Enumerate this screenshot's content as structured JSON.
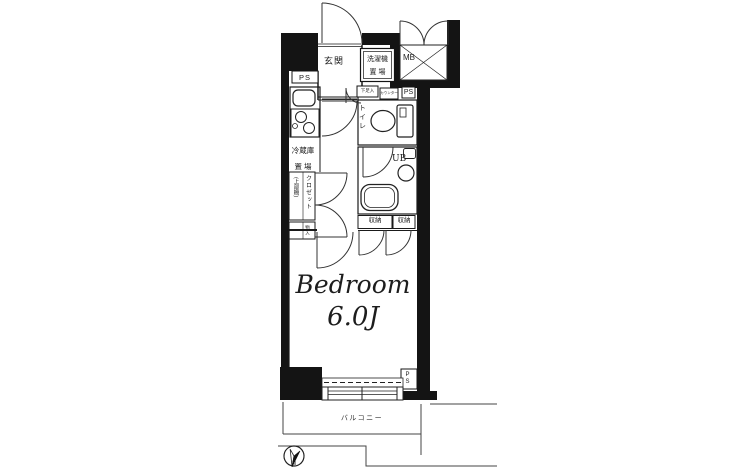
{
  "labels": {
    "genkan": "玄関",
    "ps_top": "PS",
    "washer_line1": "洗濯機",
    "washer_line2": "置 場",
    "mb": "MB",
    "shoe_cupboard": "下足入",
    "counter": "カウンター",
    "ps_mid": "PS",
    "toilet": "トイレ",
    "fridge_line1": "冷蔵庫",
    "fridge_line2": "置 場",
    "closet_name": "クロゼット",
    "closet_note": "(上部棚)",
    "closet_lower": "物入",
    "ub": "UB",
    "storage_left": "収納",
    "storage_right": "収納",
    "bedroom_name": "Bedroom",
    "bedroom_size": "6.0J",
    "ps_bottom": "PS",
    "balcony": "バルコニー",
    "compass_north": "N"
  },
  "colors": {
    "wall": "#141414",
    "line": "#222222",
    "balcony_line": "#444444"
  }
}
